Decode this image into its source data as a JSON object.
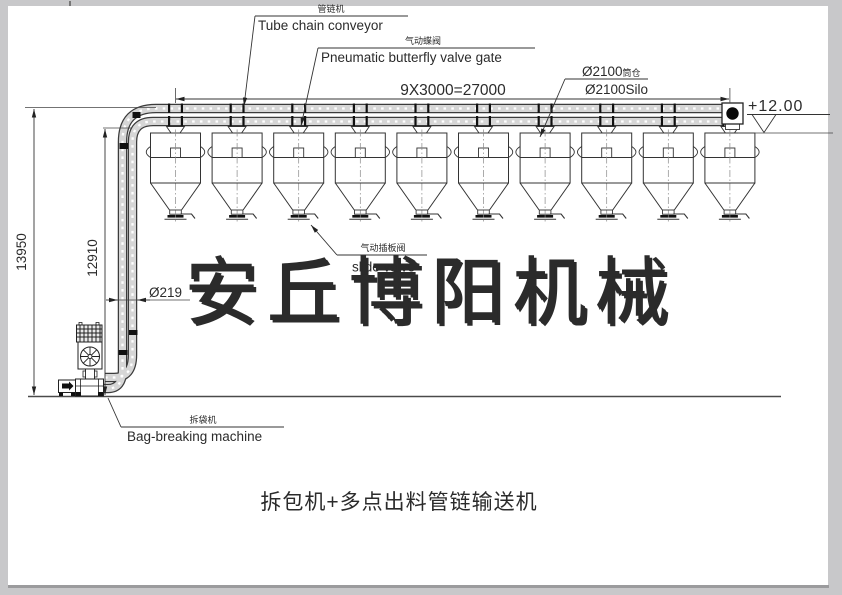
{
  "drawing": {
    "title": "拆包机+多点出料管链输送机",
    "watermark": "安丘博阳机械"
  },
  "labels": {
    "tube_chain_conveyor": {
      "cn": "管链机",
      "en": "Tube chain conveyor"
    },
    "butterfly_valve": {
      "cn": "气动蝶阀",
      "en": "Pneumatic butterfly valve gate"
    },
    "silo": {
      "cn_dia": "Ø2100",
      "cn_suffix": "筒仓",
      "en": "Ø2100Silo"
    },
    "slide_valve": {
      "cn": "气动插板阀",
      "en": "slide valve"
    },
    "bag_breaking_machine": {
      "cn": "拆袋机",
      "en": "Bag-breaking machine"
    }
  },
  "dimensions": {
    "silo_spacing": "9X3000=27000",
    "total_height": "13950",
    "inlet_height": "12910",
    "pipe_diameter": "Ø219",
    "top_elevation": "+12.00"
  },
  "silos": {
    "count": 10
  },
  "colors": {
    "line": "#333333",
    "tube_fill": "#d6d6d6",
    "paper": "#ffffff",
    "surround": "#c8c8ca",
    "watermark_shadow": "#bdbdbd"
  }
}
